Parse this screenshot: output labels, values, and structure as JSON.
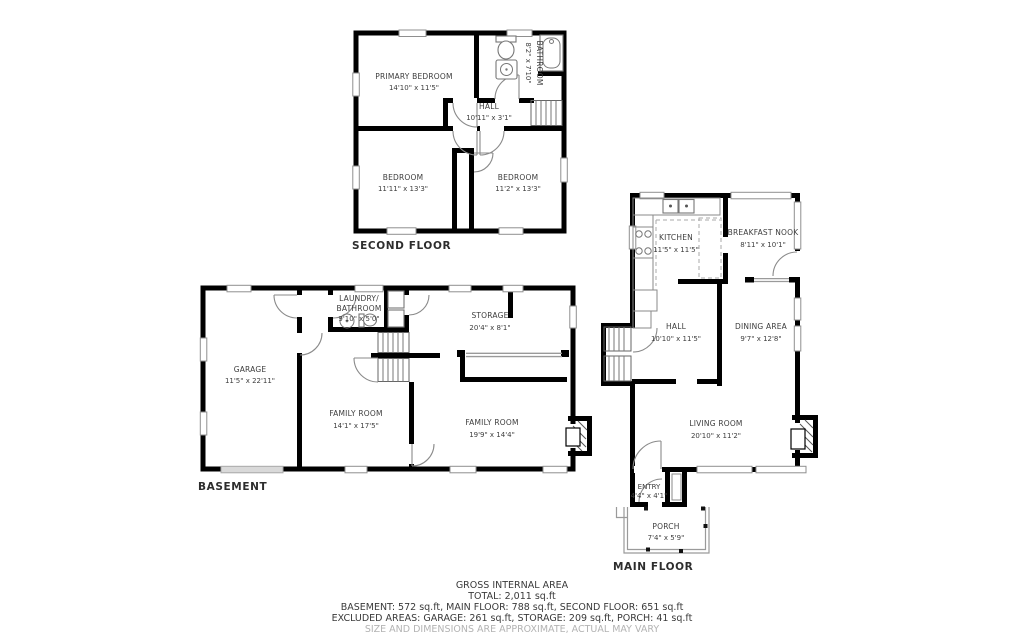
{
  "floors": {
    "second": {
      "label": "SECOND FLOOR",
      "rooms": {
        "primary": {
          "name": "PRIMARY BEDROOM",
          "dims": "14'10\" x 11'5\""
        },
        "bathroom": {
          "name": "BATHROOM",
          "dims": "8'2\" x 7'10\""
        },
        "hall": {
          "name": "HALL",
          "dims": "10'11\" x 3'1\""
        },
        "bedroom_left": {
          "name": "BEDROOM",
          "dims": "11'11\" x 13'3\""
        },
        "bedroom_right": {
          "name": "BEDROOM",
          "dims": "11'2\" x 13'3\""
        }
      }
    },
    "basement": {
      "label": "BASEMENT",
      "rooms": {
        "garage": {
          "name": "GARAGE",
          "dims": "11'5\" x 22'11\""
        },
        "laundry": {
          "name_line1": "LAUNDRY/",
          "name_line2": "BATHROOM",
          "dims": "9'10\" x 5'0\""
        },
        "storage": {
          "name": "STORAGE",
          "dims": "20'4\" x 8'1\""
        },
        "family_mid": {
          "name": "FAMILY ROOM",
          "dims": "14'1\" x 17'5\""
        },
        "family_right": {
          "name": "FAMILY ROOM",
          "dims": "19'9\" x 14'4\""
        }
      }
    },
    "main": {
      "label": "MAIN FLOOR",
      "rooms": {
        "kitchen": {
          "name": "KITCHEN",
          "dims": "11'5\" x 11'5\""
        },
        "nook": {
          "name": "BREAKFAST NOOK",
          "dims": "8'11\" x 10'1\""
        },
        "hall": {
          "name": "HALL",
          "dims": "10'10\" x 11'5\""
        },
        "dining": {
          "name": "DINING AREA",
          "dims": "9'7\" x 12'8\""
        },
        "living": {
          "name": "LIVING ROOM",
          "dims": "20'10\" x 11'2\""
        },
        "entry": {
          "name": "ENTRY",
          "dims": "4'4\" x 4'1\""
        },
        "porch": {
          "name": "PORCH",
          "dims": "7'4\" x 5'9\""
        }
      }
    }
  },
  "summary": {
    "heading": "GROSS INTERNAL AREA",
    "total": "TOTAL: 2,011 sq.ft",
    "floors_line": "BASEMENT: 572 sq.ft, MAIN FLOOR: 788 sq.ft, SECOND FLOOR: 651 sq.ft",
    "excluded_line": "EXCLUDED AREAS: GARAGE: 261 sq.ft, STORAGE: 209 sq.ft, PORCH: 41 sq.ft",
    "disclaimer": "SIZE AND DIMENSIONS ARE APPROXIMATE, ACTUAL MAY VARY"
  },
  "colors": {
    "wall": "#000000",
    "text": "#3d3d3d",
    "muted": "#b3b3b3",
    "window": "#8f8f8f"
  }
}
